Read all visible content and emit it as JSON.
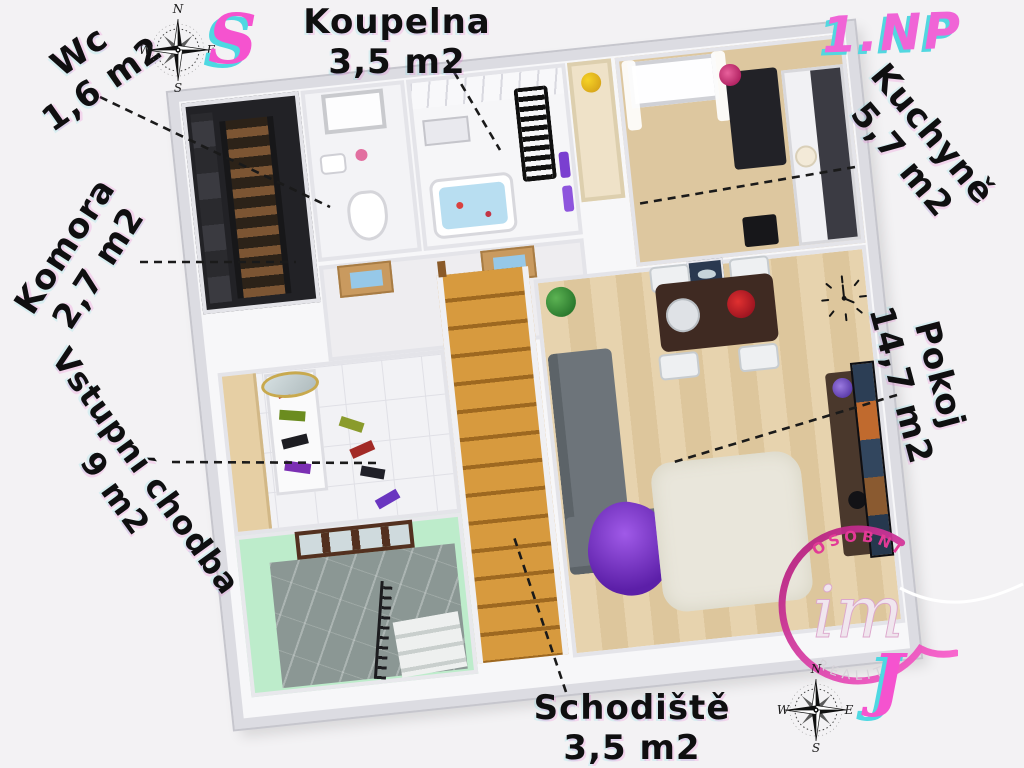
{
  "page": {
    "floor_label": "1.NP"
  },
  "decorative_letters": {
    "north_letter": "S",
    "south_letter": "J"
  },
  "compass_points": {
    "n": "N",
    "e": "E",
    "s": "S",
    "w": "W"
  },
  "rooms": {
    "wc": {
      "name": "Wc",
      "area": "1,6 m2"
    },
    "koupelna": {
      "name": "Koupelna",
      "area": "3,5 m2"
    },
    "komora": {
      "name": "Komora",
      "area": "2,7 m2"
    },
    "vstupni_chodba": {
      "name": "Vstupní chodba",
      "area": "9 m2"
    },
    "schodiste": {
      "name": "Schodiště",
      "area": "3,5 m2"
    },
    "kuchyne": {
      "name": "Kuchyně",
      "area": "5,7 m2"
    },
    "pokoj": {
      "name": "Pokoj",
      "area": "14,7 m2"
    }
  },
  "watermark": {
    "top_text": "OSOBNÍ",
    "script_text": "im",
    "bottom_text": "REALITY"
  },
  "icons": {
    "compass_top": "compass-rose-icon",
    "compass_bottom": "compass-rose-icon"
  },
  "colors": {
    "accent_pink": "#f553cf",
    "accent_cyan": "#4ed8e2",
    "label_ink": "#0f0f10",
    "mint_wall": "#bdeccb",
    "stair_wood": "#d79a3e"
  }
}
